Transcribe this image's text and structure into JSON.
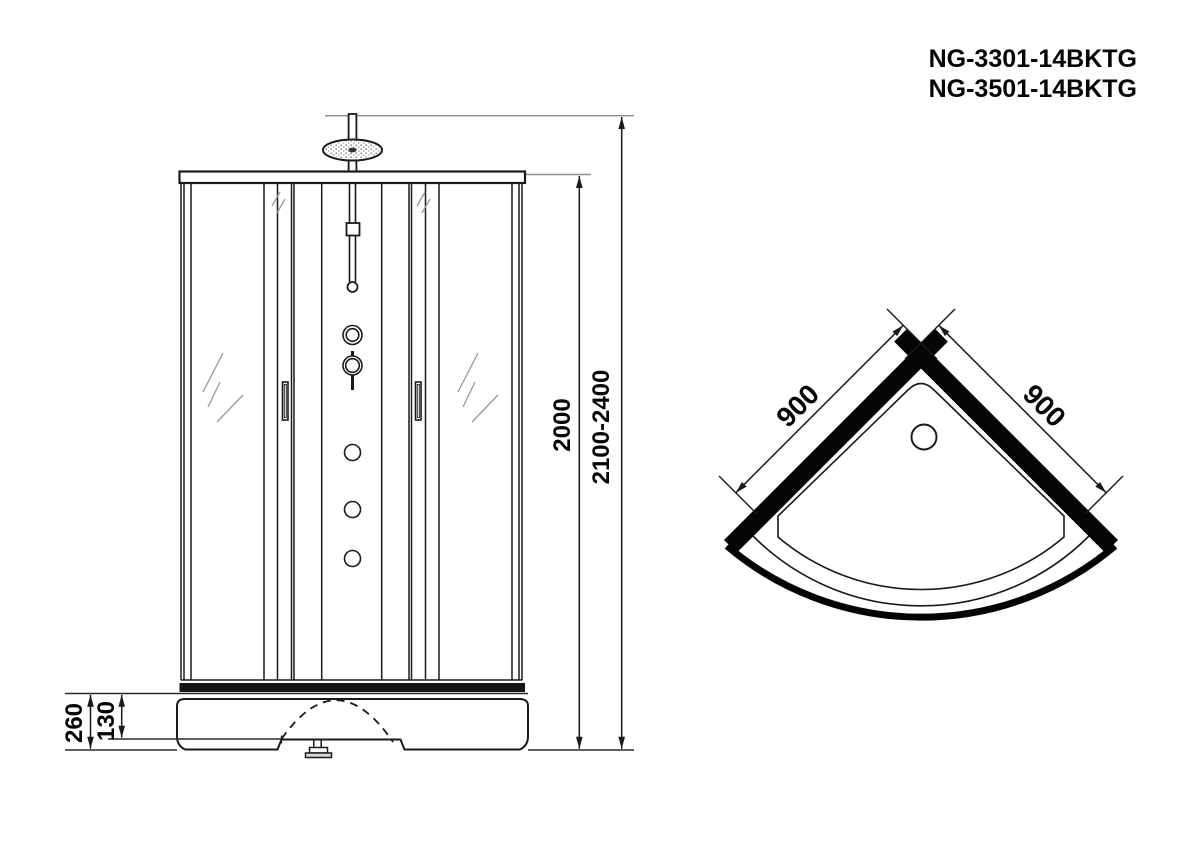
{
  "title": {
    "model_1": "NG-3301-14BKTG",
    "model_2": "NG-3501-14BKTG"
  },
  "front_view": {
    "name": "front-elevation",
    "dim_inner_height": "2000",
    "dim_overall_height": "2100-2400",
    "dim_base_height": "260",
    "dim_base_step": "130"
  },
  "top_view": {
    "name": "plan-view",
    "dim_side_left": "900",
    "dim_side_right": "900"
  },
  "colors": {
    "line": "#1a1a1a",
    "light_line": "#8c8c8c",
    "background": "#ffffff"
  }
}
